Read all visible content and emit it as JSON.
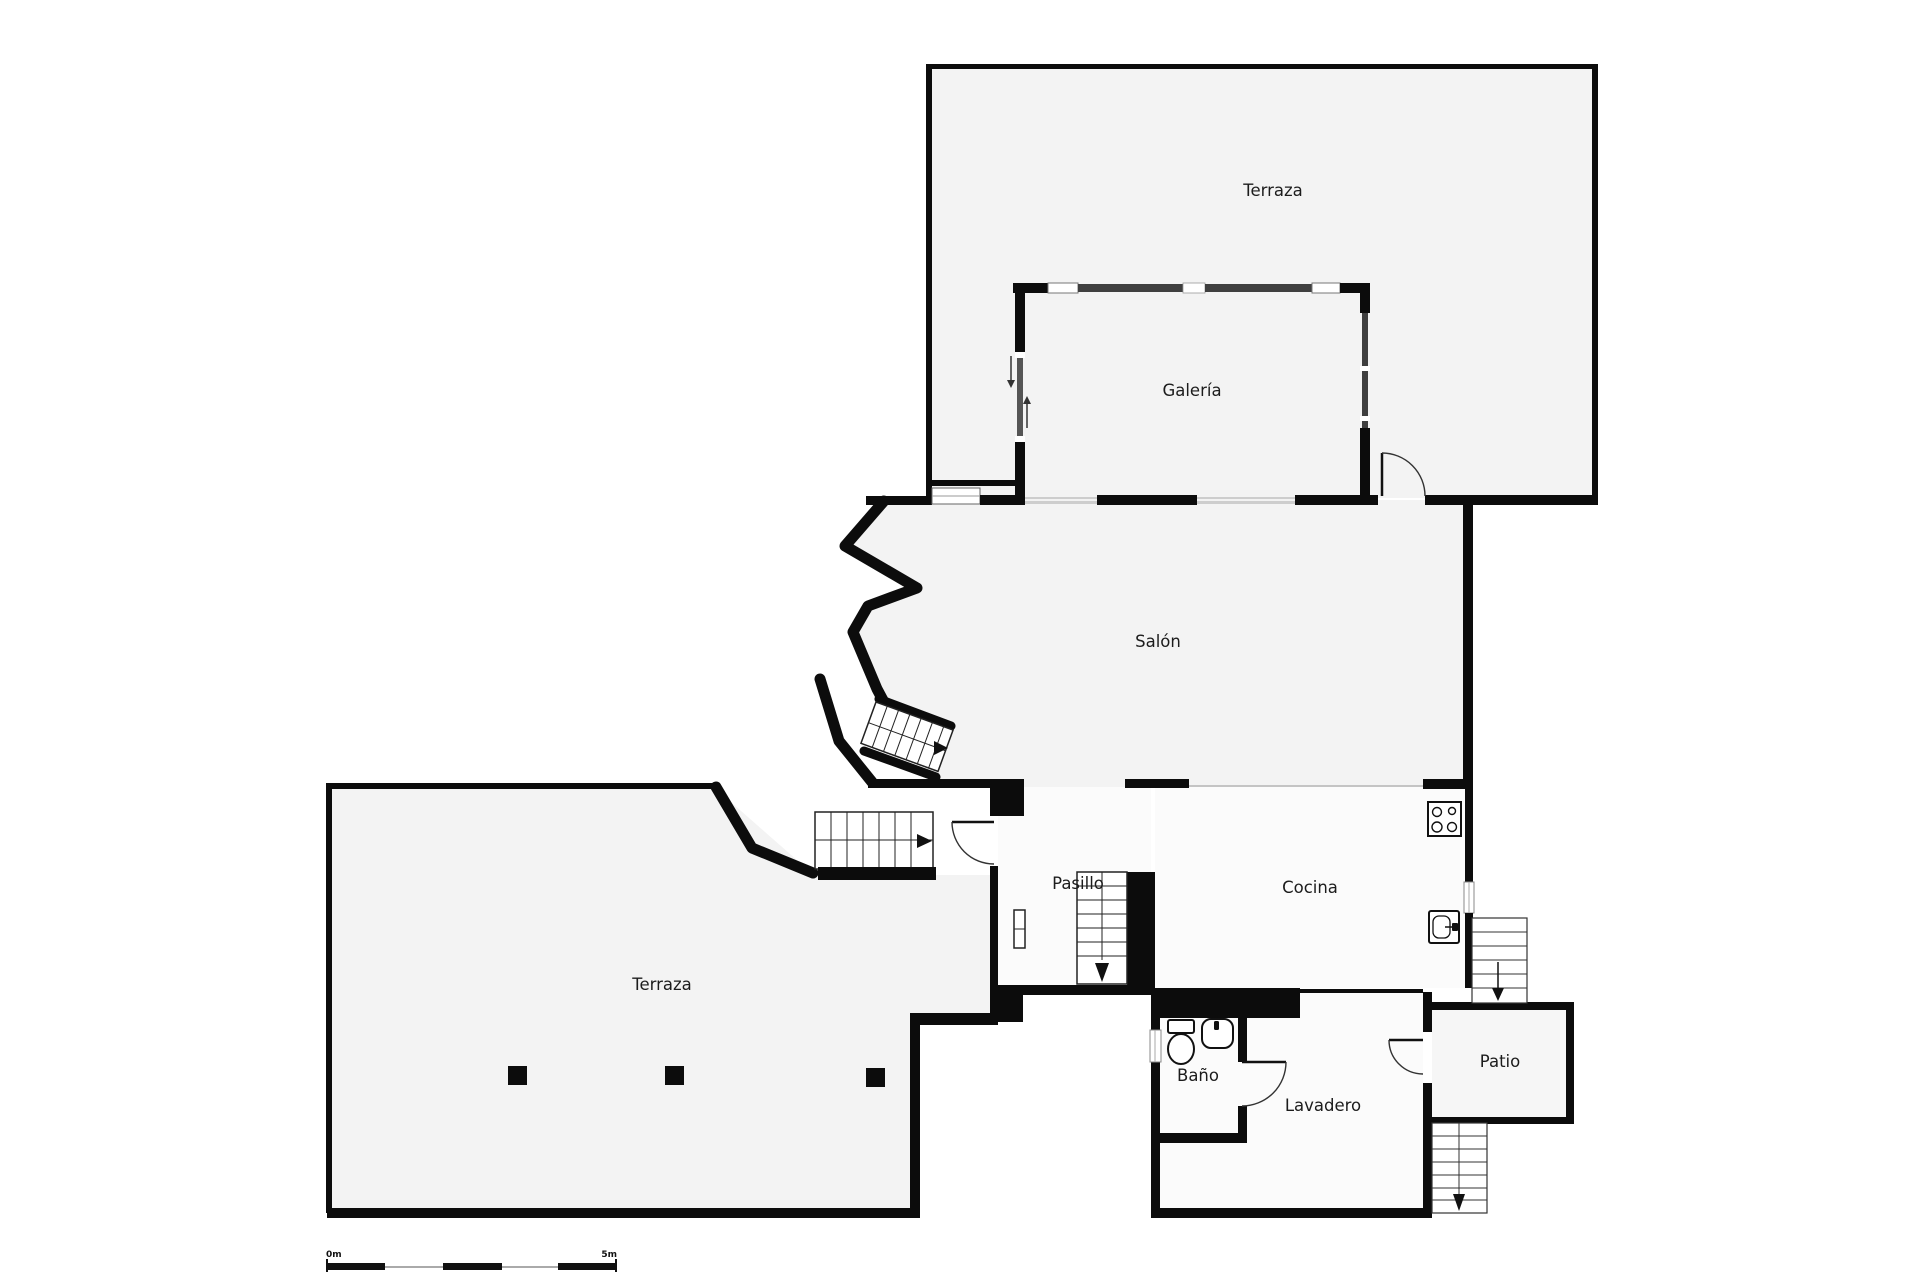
{
  "title": "Floor plan",
  "rooms": [
    {
      "id": "terraza-top",
      "label": "Terraza"
    },
    {
      "id": "galeria",
      "label": "Galería"
    },
    {
      "id": "salon",
      "label": "Salón"
    },
    {
      "id": "terraza-bottom",
      "label": "Terraza"
    },
    {
      "id": "pasillo",
      "label": "Pasillo"
    },
    {
      "id": "cocina",
      "label": "Cocina"
    },
    {
      "id": "bano",
      "label": "Baño"
    },
    {
      "id": "lavadero",
      "label": "Lavadero"
    },
    {
      "id": "patio",
      "label": "Patio"
    }
  ],
  "scale_bar": {
    "start_label": "0m",
    "end_label": "5m"
  },
  "fixtures": [
    "stove-icon",
    "kitchen-sink-icon",
    "toilet-icon",
    "bathroom-sink-icon",
    "radiator-icon",
    "stairs-icon",
    "door-arc-icon",
    "sliding-door-arrow-icon"
  ],
  "colors": {
    "wall": "#0c0c0c",
    "room_fill": "#f3f3f3",
    "service_room_fill": "#fbfbfb",
    "glazing": "#3f3f3f",
    "window_glass": "#cdcdcd",
    "outside": "#ffffff"
  }
}
